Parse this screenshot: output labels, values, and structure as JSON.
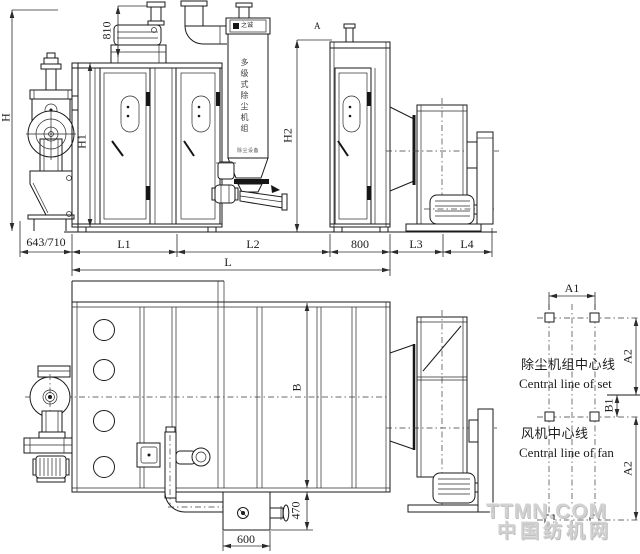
{
  "drawing": {
    "elevation": {
      "dim_h": "H",
      "dim_h1": "H1",
      "dim_h2": "H2",
      "dim_810": "810",
      "dim_643_710": "643/710",
      "dim_l1": "L1",
      "dim_l2": "L2",
      "dim_800": "800",
      "dim_l3": "L3",
      "dim_l4": "L4",
      "dim_l": "L",
      "marker_a": "A",
      "tower": {
        "logo_text": "之诚",
        "name_vertical": "多级式除尘机组",
        "sub_label": "除尘设备"
      }
    },
    "plan": {
      "dim_b": "B",
      "dim_470": "470",
      "dim_600": "600"
    },
    "foundation": {
      "dim_a1": "A1",
      "dim_a2_top": "A2",
      "dim_b1": "B1",
      "dim_a2_bottom": "A2",
      "set_line_cn": "除尘机组中心线",
      "set_line_en": "Central line of set",
      "fan_line_cn": "风机中心线",
      "fan_line_en": "Central line of fan"
    },
    "watermark": {
      "line1": "TTMN.COM",
      "line2": "中国纺机网"
    },
    "colors": {
      "line": "#1a1a1a",
      "dimension": "#2b2b2b",
      "watermark": "#d0d0d0",
      "background": "#ffffff"
    }
  }
}
